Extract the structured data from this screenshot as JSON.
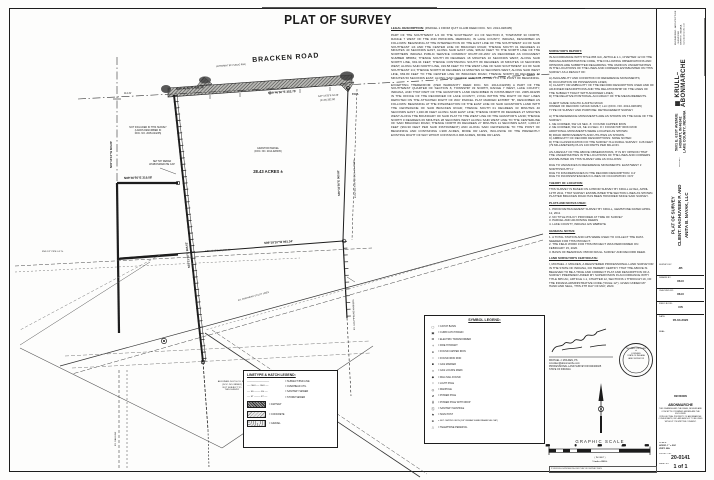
{
  "sheet": {
    "title": "PLAT OF SURVEY"
  },
  "map": {
    "road_label": "BRACKEN ROAD",
    "road_rw": "(APPARENT 80' PUBLIC R/W)",
    "pob": "P.O.B.",
    "acreage": "28.43 ACRES ±",
    "parcel_note": [
      "GRANTOR PARCEL",
      "(DOC. NO. 2014-028435)"
    ],
    "west_note": [
      "NOT INCLUDED IN THIS SURVEY",
      "(LANDS DESCRIBED IN",
      "DOC. NO. 2005-024235)"
    ],
    "west_note2": [
      "SET 5/8\" REBAR",
      "W/ABONMARCHE CAP"
    ],
    "adjoiner_note": [
      "ADJOINER: N.I.P.S.CO. R/W",
      "(DOC. NO. 885861)",
      "NOT SUBJECT TO",
      "THIS SURVEY"
    ],
    "esmt_label": "EX. 30' INGRESS-EGRESS ESMT.",
    "ohu_label": "EX. OVERHEAD UTILITY LINES",
    "fnd1": "FND 1/2\" PIPE 0.3' N.",
    "stub_label": "EX. GAS PIPELINE MARKERS",
    "gas": "EX. GAS LINE",
    "dims": {
      "road_w": "N89°46'50\"E  983.29'",
      "road_e": "N89°46'50\"E  352.75'",
      "road_end": "S47°14'25\"E 54.43'",
      "road_end2": "(R+M) 352.38'",
      "qtr": "114.31'",
      "west_stub": "N89°46'50\"E  319.58'",
      "section": "N00°13'10\"W  663.80'",
      "lane": "S01°21'40\"E  986.62'",
      "east": "S00°32'50\"E  963.81'",
      "rw": "EXISTING R/W PER DOC. NO. 885861",
      "south": "S89°18'10\"W  991.34'",
      "south2": "N89°18'10\"E (R)  664.91'"
    }
  },
  "legal": {
    "heading": "LEGAL DESCRIPTION:",
    "sub": "(PARCEL 1 FROM QUIT CLAIM DEED DOC. NO. 2014-028435)",
    "p1": "PART OF THE SOUTHWEST 1/4 OF THE SOUTHEAST 1/4 OF SECTION 8, TOWNSHIP 33 NORTH, RANGE 7 WEST OF THE 2ND PRINCIPAL MERIDIAN, IN LAKE COUNTY, INDIANA, DESCRIBED AS FOLLOWS: BEGINNING AT THE INTERSECTION OF THE EAST LINE OF THE SOUTHWEST 1/4 OF SAID SOUTHEAST 1/4 AND THE CENTER LINE OF BRACKEN ROAD; THENCE SOUTH 01 DEGREES 21 MINUTES 40 SECONDS EAST, ALONG SAID EAST LINE, 986.62 FEET TO THE NORTH LINE OF THE NORTHERN INDIANA PUBLIC SERVICE COMPANY RIGHT-OF-WAY AS RECORDED AS DOCUMENT NUMBER 885861; THENCE SOUTH 89 DEGREES 18 MINUTES 10 SECONDS WEST, ALONG SAID NORTH LINE, 991.34 FEET; THENCE CONTINUING SOUTH 89 DEGREES 18 MINUTES 10 SECONDS WEST, ALONG SAID NORTH LINE, 319.58 FEET TO THE WEST LINE OF SAID SOUTHWEST 1/4 OF SAID SOUTHEAST 1/4; THENCE NORTH 00 DEGREES 13 MINUTES 10 SECONDS WEST, ALONG SAID WEST LINE, 663.80 FEET TO THE CENTER LINE OF BRACKEN ROAD; THENCE NORTH 89 DEGREES 46 MINUTES 50 SECONDS EAST, ALONG SAID CENTER LINE, 983.29 FEET TO THE POINT OF BEGINNING.",
    "p2": "EXCEPTING THEREFROM: (PER WARRANTY DEED DOC. NO. 2014-042258) A PART OF THE SOUTHWEST QUARTER OF SECTION 8, TOWNSHIP 33 NORTH, RANGE 7 WEST, LAKE COUNTY, INDIANA, AND THAT PART OF THE GRANTOR'S LAND DESCRIBED IN INSTRUMENT NO. 2005-024235 IN THE OFFICE OF THE RECORDER OF LAKE COUNTY, LYING WITHIN THE RIGHT OF WAY LINES DEPICTED ON THE ATTACHED RIGHT OF WAY PARCEL PLAT MARKED EXHIBIT \"B\", DESCRIBED AS FOLLOWS: BEGINNING AT THE INTERSECTION OF THE EAST LINE OF SAID GRANTOR'S LAND WITH THE CENTERLINE OF SAID BRACKEN ROAD; THENCE SOUTH 01 DEGREES 33 MINUTES 40 SECONDS EAST 1,320.06 FEET ALONG SAID EAST LINE; THENCE NORTH 89 DEGREES 27 MINUTES WEST ALONG THE BOUNDARY OF SAID PLAT TO THE WEST LINE OF THE GRANTOR'S LAND; THENCE NORTH 0 DEGREES 06 MINUTES 28 SECONDS WEST ALONG SAID WEST LINE TO THE CENTERLINE OF SAID BRACKEN ROAD; THENCE NORTH 89 DEGREES 27 MINUTES 11 SECONDS EAST, 1,063.17 FEET (964.30 FEET PER SAID INSTRUMENT) AND ALONG SAID CENTERLINE TO THE POINT OF BEGINNING AND CONTAINING 1.908 ACRES, MORE OR LESS, INCLUSIVE OF THE PRESENTLY EXISTING RIGHT OF WAY WHICH CONTAINS 0.908 ACRES, MORE OR LESS."
  },
  "legend_symbols": {
    "title": "SYMBOL LEGEND:",
    "items": [
      {
        "glyph": "▢",
        "label": "=  CATCH BASIN"
      },
      {
        "glyph": "▣",
        "label": "=  CURB CATCH BASIN"
      },
      {
        "glyph": "⊠",
        "label": "=  ELECTRIC TRANSFORMER"
      },
      {
        "glyph": "+",
        "label": "=  FIRE HYDRANT"
      },
      {
        "glyph": "●",
        "label": "=  FOUND CAPPED IRON"
      },
      {
        "glyph": "○",
        "label": "=  FOUND IRON ROD"
      },
      {
        "glyph": "■",
        "label": "=  GAS MARKER"
      },
      {
        "glyph": "×",
        "label": "=  GAS LOCATE MARK"
      },
      {
        "glyph": "◆",
        "label": "=  MAG NAIL FOUND"
      },
      {
        "glyph": "☼",
        "label": "=  LIGHT POLE"
      },
      {
        "glyph": "◎",
        "label": "=  MANHOLE"
      },
      {
        "glyph": "ø",
        "label": "=  POWER POLE"
      },
      {
        "glyph": "ɸ",
        "label": "=  POWER POLE WITH DROP"
      },
      {
        "glyph": "Ⓢ",
        "label": "=  SANITARY MANHOLE"
      },
      {
        "glyph": "⚑",
        "label": "=  SIGN POST"
      },
      {
        "glyph": "⊕",
        "label": "=  SET CAPPED IRON (5/8\" REBAR W/ABONMARCHE CAP)"
      },
      {
        "glyph": "△",
        "label": "=  TELEPHONE PEDESTAL"
      }
    ]
  },
  "legend_lines": {
    "title": "LINETYPE & HATCH LEGEND:",
    "items": [
      {
        "sample": "─────────────",
        "label": "=  SUBJECT BND LINE"
      },
      {
        "sample": "── OHU ── OHU ──",
        "label": "=  OVERHEAD UTIL"
      },
      {
        "sample": "── SS ──── SS ──",
        "label": "=  SANITARY SEWER"
      },
      {
        "sample": "── ST ──── ST ──",
        "label": "=  STORM SEWER"
      }
    ],
    "hatches": [
      {
        "label": "=  ASPHALT"
      },
      {
        "label": "=  CONCRETE"
      },
      {
        "label": "=  GRAVEL"
      }
    ]
  },
  "report": {
    "heading": "SURVEYOR'S REPORT:",
    "intro": "IN ACCORDANCE WITH TITLE 865 IAC, ARTICLE 1.1, CHAPTER 12 OF THE INDIANA ADMINISTRATIVE CODE, THE FOLLOWING OBSERVATIONS AND OPINIONS ARE SUBMITTED REGARDING THE VARIOUS UNCERTAINTIES IN THE LOCATIONS OF THE LINES AND CORNERS ESTABLISHED ON THIS SURVEY AS A RESULT OF:",
    "causes": [
      "A)   AVAILABILITY AND CONDITION OF REFERENCE MONUMENTS;",
      "B)   OCCUPATION OR POSSESSION LINES;",
      "C)   CLARITY OR AMBIGUITY OF THE RECORD DESCRIPTION USED AND OF ADJOINER DESCRIPTIONS AND THE RELATIONSHIP OF THE LINES OF THE SUBJECT TRACT WITH ADJOINER LINES;",
      "D)   THE RELATIVE POSITIONAL ACCURACY OF THE MEASUREMENTS."
    ],
    "client": [
      "CLIENT NAME:  RAGHU & ANITA NAYAK",
      "OWNER OF RECORD:  NAYAK FAMILY, LLC  (DOC. NO. 2014-028435)",
      "TYPE OF SURVEY AND PURPOSE:  RETRACEMENT SURVEY"
    ],
    "monuments": [
      "A)   THE REFERENCE MONUMENTS ARE AS SHOWN ON THE FACE OF THE SURVEY:",
      "1.    NE CORNER, SW 1/4 SEC. 8:  I FOUND CAPPED IRON",
      "2.    NE CORNER, SW 1/4, SE 1/4 SEC. 8:  I FOUND 5/8\" IRON ROD",
      "       ADDITIONAL MONUMENTS WERE LOCATED AS SHOWN.",
      "B)   ROAD IMPROVEMENTS AND UTILITIES AS SHOWN.",
      "C)   AMBIGUITY OF RECORD DESCRIPTIONS:  NONE NOTED",
      "D)   THE CLASSIFICATION OF THE SURVEY IS A RURAL SURVEY:  0.26 FEET (79 MILLIMETERS) PLUS 100 PARTS PER MILLION."
    ],
    "opinion": "AS A RESULT OF THE ABOVE OBSERVATIONS, IT IS MY OPINION THAT THE UNCERTAINTIES IN THE LOCATIONS OF THE LINES AND CORNERS ESTABLISHED ON THIS SURVEY ARE AS FOLLOWS:",
    "uncertainties": [
      "DUE TO VARIANCES IN REFERENCE MONUMENTS:  EAST/WEST 1'  NORTH/SOUTH 1'",
      "DUE TO DISCREPANCIES IN THE RECORD DESCRIPTION:  0.2'",
      "DUE TO INCONSISTENCIES IN LINES OF OCCUPATION:  ±0.5'"
    ],
    "theory_heading": "THEORY OF LOCATION:",
    "theory": "THIS SURVEY IS BASED ON A PRIOR SURVEY BY KRULL ALYEA, APRIL 12TH 2011, THAT SURVEY ESTABLISHED THE SECTION LINES AS SHOWN. PLATTED BRACKEN ROAD HAS BEEN HONORED SINCE SAID SURVEY.",
    "plats_heading": "PLATS AND NOTES USED:",
    "plats": [
      "1.    PRIOR RETRACEMENT SURVEY BY KRULL, GEMSTONE DATED APRIL 12, 2011",
      "2.    NO TITLE POLICY PROVIDED AT TIME OF SURVEY",
      "3.    PARCEL AND ADJOINING DEEDS",
      "4.    LAKE COUNTY, INDIANA GIS WEBSITE"
    ],
    "notes_heading": "GENERAL NOTES:",
    "notes": [
      "1.    A TOTAL STATION AND GPS WERE USED TO COLLECT THE DATA NEEDED FOR THIS PROJECT.",
      "2.    THE FIELD WORK FOR THIS PROJECT WAS PERFORMED ON FEBRUARY 15, 2020.",
      "3.    BASIS OF BEARINGS:  PRIOR KRULL SURVEY AND RECORD DEED."
    ],
    "cert_heading": "LAND SURVEYOR'S CERTIFICATE:",
    "cert": "I, MICHAEL J. MOLDEN, A REGISTERED PROFESSIONAL LAND SURVEYOR IN THE STATE OF INDIANA, DO HEREBY CERTIFY THAT THE ABOVE IS BELIEVED TO BE A TRUE AND CORRECT PLAT AND DESCRIPTION OF A SURVEY PREPARED UNDER MY SUPERVISION IN ACCORDANCE WITH TITLE 865 IAC, ARTICLE 1.1, CHAPTER 12, SECTIONS 1 THROUGH 19, OF THE INDIANA ADMINISTRATIVE CODE (\"RULE 12\"). GIVEN UNDER MY HAND AND SEAL, THIS 4TH DAY OF MAY, 2020.",
    "surveyor": [
      "MICHAEL J. MOLDEN, PS",
      "mmolden@abonmarche.com",
      "PROFESSIONAL LAND SURVEYOR #20400025",
      "STATE OF INDIANA"
    ],
    "seal": [
      "MICHAEL J. MOLDEN",
      "★",
      "LICENSED",
      "STATE OF INDIANA",
      "LAND SURVEYOR"
    ]
  },
  "scalebar": {
    "title": "GRAPHIC SCALE",
    "ticks": [
      "200",
      "0",
      "200",
      "400",
      "800"
    ],
    "feet": "( IN FEET )",
    "ratio": "1 inch = 200 ft."
  },
  "titleblock": {
    "firm": "▦ KRULL–ABONMARCHE",
    "firm_sub": [
      "ENGINEERING · ARCHITECTURE · SURVEYING",
      "GRIFFITH, INDIANA",
      "www.abonmarche.com"
    ],
    "address": [
      "5601 E. 61ST AVENUE",
      "HOBART, IN 46342",
      "LAKE COUNTY, INDIANA"
    ],
    "project_label": "PROJECT:",
    "project_title": [
      "PLAT OF SURVEY",
      "CLIENT: RAGHUVEER P. AND",
      "ANITA B. NAYAK, LLC"
    ],
    "fields": [
      {
        "label": "SURVEY BY:",
        "value": "JB"
      },
      {
        "label": "DRAWN BY:",
        "value": "RLN"
      },
      {
        "label": "CHECKED BY:",
        "value": "RLN"
      },
      {
        "label": "FIELD BOOK:",
        "value": "CB"
      },
      {
        "label": "DATE:",
        "value": "05.04.2020"
      }
    ],
    "seal_label": "SEAL:",
    "revisions_label": "REVISIONS",
    "mini_firm": "ABONMARCHE",
    "mini_lines": [
      "THIS DRAWING AND THE IDEAS, DESIGNS AND",
      "CONCEPTS CONTAINED HEREIN ARE THE EXCLUSIVE",
      "INTELLECTUAL PROPERTY OF ABONMARCHE",
      "CONSULTANTS, INC. AND ARE NOT TO BE USED",
      "WITHOUT ITS WRITTEN CONSENT."
    ],
    "scale_label": "SCALE:",
    "scale_h": "HORIZ:  1\" = 200'",
    "scale_v": "VERT:  N/A",
    "project_no_label": "PROJECT NO.",
    "project_no": "20-0141",
    "sheet_label": "SHEET NO.",
    "sheet": "1 of 1",
    "path": "P:\\2020\\20-0141\\DWG\\20-0141 PLAT OF SURVEY.DWG"
  }
}
